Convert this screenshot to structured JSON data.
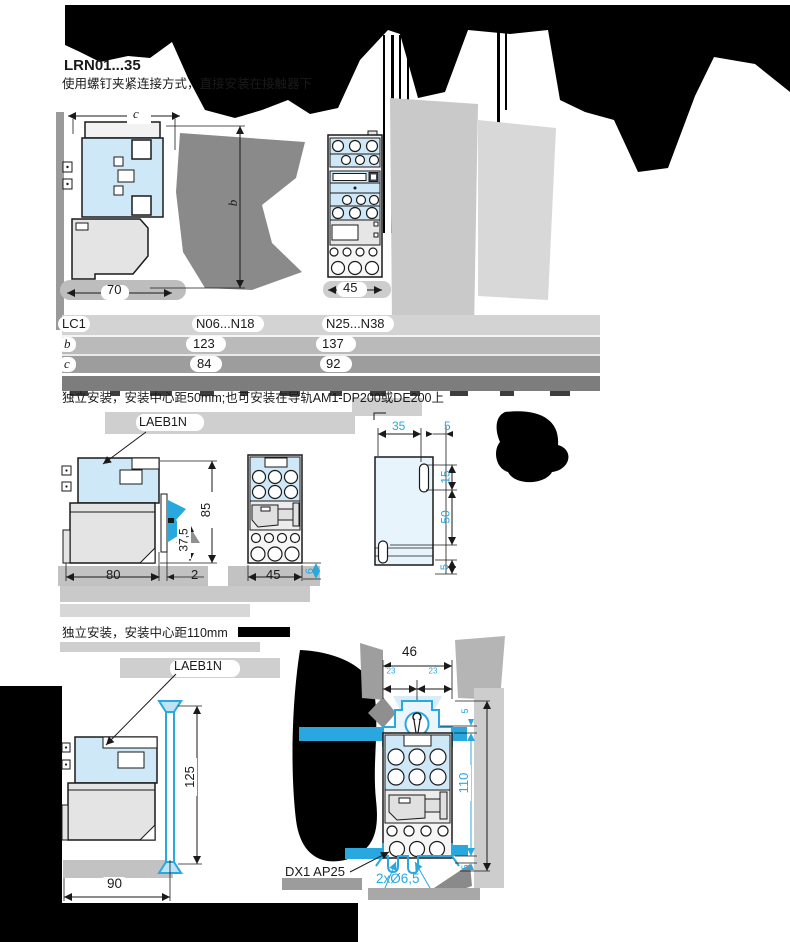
{
  "header": {
    "title": "LRN01...35",
    "subtitle": "使用螺钉夹紧连接方式，直接安装在接触器下"
  },
  "sections": {
    "standalone50": "独立安装，安装中心距50mm;也可安装在导轨AM1-DP200或DE200上",
    "standalone110": "独立安装，安装中心距110mm"
  },
  "table": {
    "columns": [
      "LC1",
      "N06...N18",
      "N25...N38"
    ],
    "rows": [
      {
        "label": "b",
        "values": [
          "123",
          "137"
        ]
      },
      {
        "label": "c",
        "values": [
          "84",
          "92"
        ]
      }
    ]
  },
  "labels": {
    "part_mid": "LAEB1N",
    "part_bottom": "LAEB1N",
    "plate": "DX1 AP25",
    "holes": "2xØ6,5"
  },
  "dims": {
    "c": "c",
    "b": "b",
    "top_side_width": "70",
    "top_front_width": "45",
    "mid_side_width": "80",
    "mid_gap": "2",
    "mid_height": "85",
    "mid_rail": "37,5",
    "mid_front_width": "45",
    "mid_offset": "6",
    "plate_top_w": "35",
    "plate_top_gap": "5",
    "plate_r1": "15",
    "plate_r2": "50",
    "plate_r3": "5",
    "bot_front_width": "46",
    "bot_half_a": "23",
    "bot_half_b": "23",
    "bot_side_width": "90",
    "bot_side_height": "125",
    "bot_center": "110",
    "bot_edge_top": "5",
    "bot_edge_bottom": "5"
  },
  "colors": {
    "accent_cyan": "#29a8e0",
    "fill_blue": "#cfe8f7",
    "fill_blue_pale": "#e8f4fb",
    "fill_gray": "#e4e4e4"
  }
}
